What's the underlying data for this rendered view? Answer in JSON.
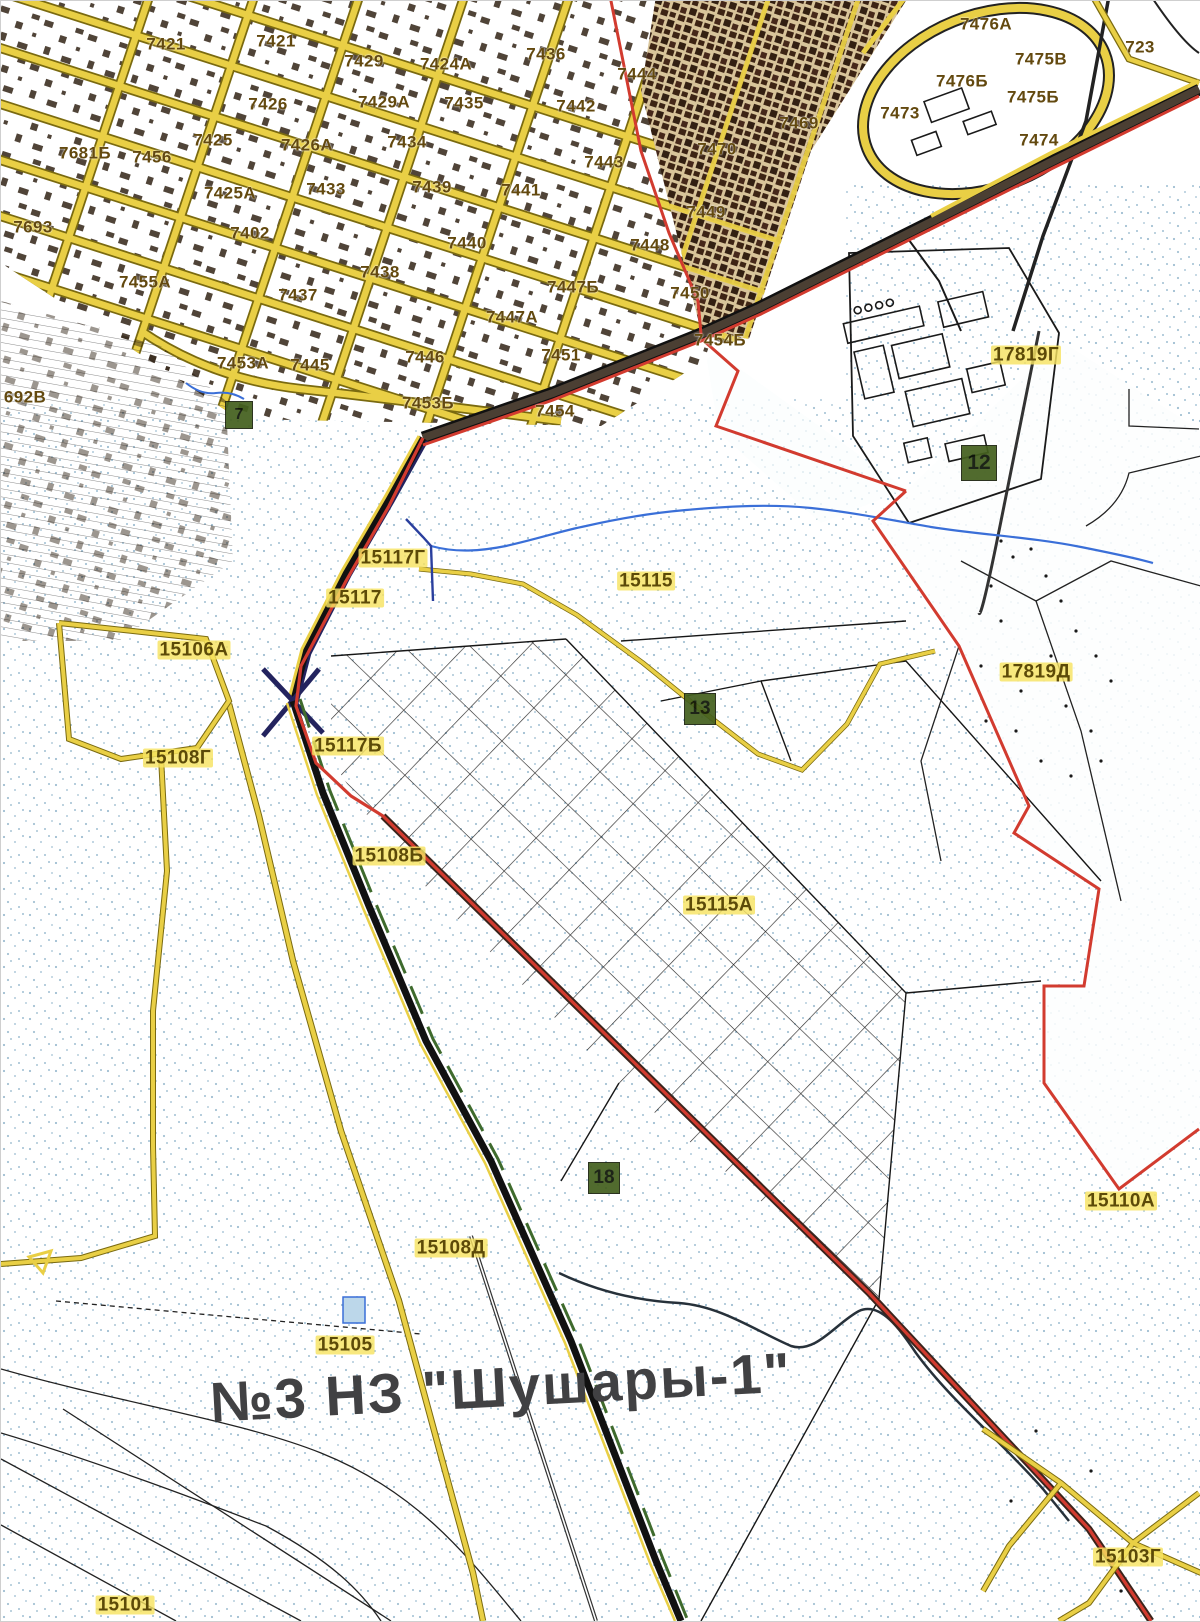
{
  "map": {
    "title": {
      "text": "№3  НЗ \"Шушары-1\"",
      "x": 500,
      "y": 1386,
      "size": 56,
      "rotate": -3
    },
    "palette": {
      "road_yellow": "#e9cf45",
      "road_casing": "#7a6a10",
      "boundary_red": "#d23b2f",
      "railway_dark": "#3a241c",
      "stream_blue": "#3a6fd8",
      "stipple_blue": "#9fbed2",
      "parcel_label": "#63490f",
      "area_label": "#5c4a08",
      "area_highlight": "#f7e361",
      "green_marker": "#44601f",
      "title_gray": "#414143"
    },
    "parcel_labels": [
      {
        "text": "7421",
        "x": 165,
        "y": 43
      },
      {
        "text": "7421",
        "x": 275,
        "y": 40
      },
      {
        "text": "7429",
        "x": 363,
        "y": 60
      },
      {
        "text": "7424А",
        "x": 445,
        "y": 63
      },
      {
        "text": "7436",
        "x": 545,
        "y": 53
      },
      {
        "text": "7444",
        "x": 636,
        "y": 73
      },
      {
        "text": "7426",
        "x": 267,
        "y": 103
      },
      {
        "text": "7429А",
        "x": 383,
        "y": 101
      },
      {
        "text": "7435",
        "x": 463,
        "y": 102
      },
      {
        "text": "7442",
        "x": 575,
        "y": 105
      },
      {
        "text": "7425",
        "x": 212,
        "y": 139
      },
      {
        "text": "7426А",
        "x": 306,
        "y": 144
      },
      {
        "text": "7434",
        "x": 406,
        "y": 141
      },
      {
        "text": "7443",
        "x": 603,
        "y": 161
      },
      {
        "text": "7681Б",
        "x": 84,
        "y": 152
      },
      {
        "text": "7456",
        "x": 151,
        "y": 156
      },
      {
        "text": "7425А",
        "x": 229,
        "y": 192
      },
      {
        "text": "7433",
        "x": 325,
        "y": 188
      },
      {
        "text": "7439",
        "x": 431,
        "y": 186
      },
      {
        "text": "7441",
        "x": 520,
        "y": 189
      },
      {
        "text": "7470",
        "x": 716,
        "y": 148
      },
      {
        "text": "7469",
        "x": 798,
        "y": 122
      },
      {
        "text": "7473",
        "x": 899,
        "y": 112
      },
      {
        "text": "7476А",
        "x": 985,
        "y": 23
      },
      {
        "text": "7475В",
        "x": 1040,
        "y": 58
      },
      {
        "text": "7476Б",
        "x": 961,
        "y": 80
      },
      {
        "text": "7475Б",
        "x": 1032,
        "y": 96
      },
      {
        "text": "7474",
        "x": 1038,
        "y": 139
      },
      {
        "text": "723",
        "x": 1139,
        "y": 46
      },
      {
        "text": "7693",
        "x": 32,
        "y": 226
      },
      {
        "text": "7402",
        "x": 249,
        "y": 232
      },
      {
        "text": "7440",
        "x": 466,
        "y": 242
      },
      {
        "text": "7438",
        "x": 379,
        "y": 271
      },
      {
        "text": "7437",
        "x": 297,
        "y": 294
      },
      {
        "text": "7455А",
        "x": 144,
        "y": 281
      },
      {
        "text": "7447Б",
        "x": 572,
        "y": 286
      },
      {
        "text": "7447А",
        "x": 511,
        "y": 316
      },
      {
        "text": "7448",
        "x": 649,
        "y": 244
      },
      {
        "text": "7449",
        "x": 705,
        "y": 211
      },
      {
        "text": "7450",
        "x": 689,
        "y": 292
      },
      {
        "text": "7453А",
        "x": 242,
        "y": 362
      },
      {
        "text": "7445",
        "x": 309,
        "y": 364
      },
      {
        "text": "7446",
        "x": 424,
        "y": 356
      },
      {
        "text": "7451",
        "x": 560,
        "y": 354
      },
      {
        "text": "7454Б",
        "x": 719,
        "y": 339
      },
      {
        "text": "7453Б",
        "x": 427,
        "y": 402
      },
      {
        "text": "7454",
        "x": 554,
        "y": 410
      },
      {
        "text": "692В",
        "x": 24,
        "y": 396
      }
    ],
    "area_labels": [
      {
        "text": "17819Г",
        "x": 1025,
        "y": 354
      },
      {
        "text": "15115",
        "x": 645,
        "y": 580
      },
      {
        "text": "15117Г",
        "x": 392,
        "y": 557
      },
      {
        "text": "15117",
        "x": 354,
        "y": 597
      },
      {
        "text": "15106А",
        "x": 193,
        "y": 649
      },
      {
        "text": "15117Б",
        "x": 347,
        "y": 745
      },
      {
        "text": "15108Г",
        "x": 177,
        "y": 757
      },
      {
        "text": "17819Д",
        "x": 1035,
        "y": 671
      },
      {
        "text": "15108Б",
        "x": 388,
        "y": 855
      },
      {
        "text": "15115А",
        "x": 718,
        "y": 904
      },
      {
        "text": "15110А",
        "x": 1120,
        "y": 1200
      },
      {
        "text": "15108Д",
        "x": 450,
        "y": 1247
      },
      {
        "text": "15105",
        "x": 344,
        "y": 1344
      },
      {
        "text": "15101",
        "x": 124,
        "y": 1604
      },
      {
        "text": "15103Г",
        "x": 1127,
        "y": 1556
      }
    ],
    "green_markers": [
      {
        "text": "7",
        "x": 238,
        "y": 414,
        "size": 26
      },
      {
        "text": "12",
        "x": 978,
        "y": 462,
        "size": 34
      },
      {
        "text": "13",
        "x": 699,
        "y": 708,
        "size": 30
      },
      {
        "text": "18",
        "x": 603,
        "y": 1177,
        "size": 30
      }
    ]
  }
}
